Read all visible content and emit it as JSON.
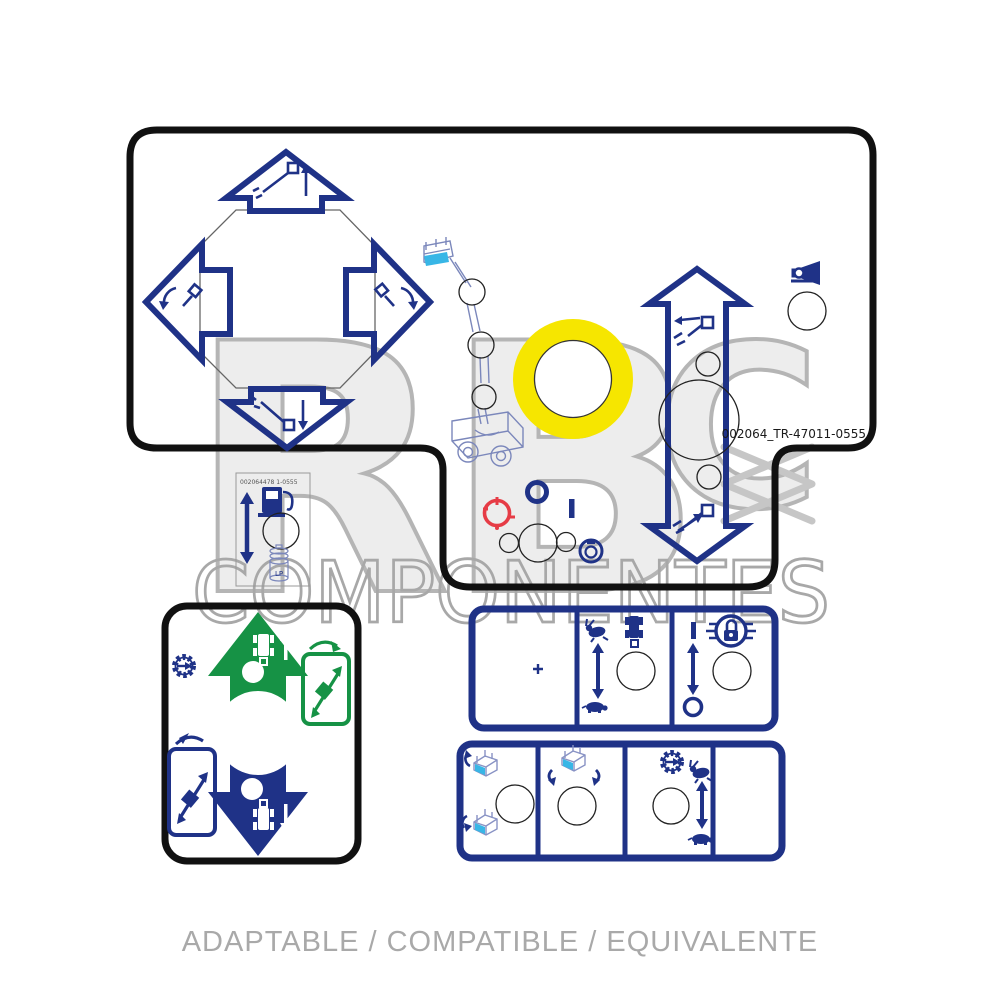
{
  "page": {
    "background": "#ffffff",
    "type": "product-image-decal-kit"
  },
  "watermark": {
    "letter_r": "R",
    "letter_b": "B",
    "letter_c": "C",
    "wordmark": "COMPONENTES"
  },
  "caption": {
    "text": "ADAPTABLE / COMPATIBLE / EQUIVALENTE"
  },
  "main_decal": {
    "part_number": "002064_TR-47011-0555",
    "icons": [
      "boom-raise-arrow-up-icon",
      "boom-lower-arrow-down-icon",
      "swing-left-arrow-icon",
      "swing-right-arrow-icon",
      "joystick-octagon-cutout",
      "articulated-boom-lift-drawing",
      "yellow-ring-pad",
      "telescope-retract-icon",
      "telescope-extend-icon",
      "vertical-double-arrow",
      "horn-icon",
      "power-on-i-symbol",
      "power-off-o-symbol",
      "emergency-red-selector-icon",
      "key-switch-icon",
      "knob-hole-circles"
    ]
  },
  "fuel_decal": {
    "part_number": "002064478 1-0555",
    "lp_label": "LP",
    "icons": [
      "fuel-pump-icon",
      "up-down-arrow",
      "lp-gas-cylinder-drawing",
      "knob-hole-circle"
    ]
  },
  "drive_decal": {
    "icons": [
      "green-up-arrow-drive-forward",
      "blue-down-arrow-drive-reverse",
      "machine-top-view-white-icon",
      "gear-select-icon",
      "platform-side-view-green-outline",
      "platform-side-view-blue-outline",
      "diagonal-double-arrows",
      "joystick-hole-circles"
    ]
  },
  "strip1": {
    "icons": [
      "plus-mark",
      "rabbit-fast-icon",
      "turtle-slow-icon",
      "speed-double-arrow",
      "machine-top-view-icon",
      "power-i-symbol",
      "power-o-symbol",
      "axle-lock-padlock-icon",
      "knob-hole-circles"
    ]
  },
  "strip2": {
    "icons": [
      "platform-level-up-icon",
      "platform-level-down-icon",
      "platform-rotate-icon",
      "gear-select-icon",
      "rabbit-fast-icon",
      "turtle-slow-icon",
      "speed-double-arrow",
      "knob-hole-circles"
    ]
  },
  "colors": {
    "navy": "#1f3287",
    "green": "#169245",
    "yellow": "#f6e600",
    "red": "#e63c46",
    "cyan": "#38b6e6",
    "lineart_blue": "#7b87bb",
    "outline_black": "#111111",
    "watermark_gray": "#b5b5b5",
    "caption_gray": "#a9a9a9"
  }
}
